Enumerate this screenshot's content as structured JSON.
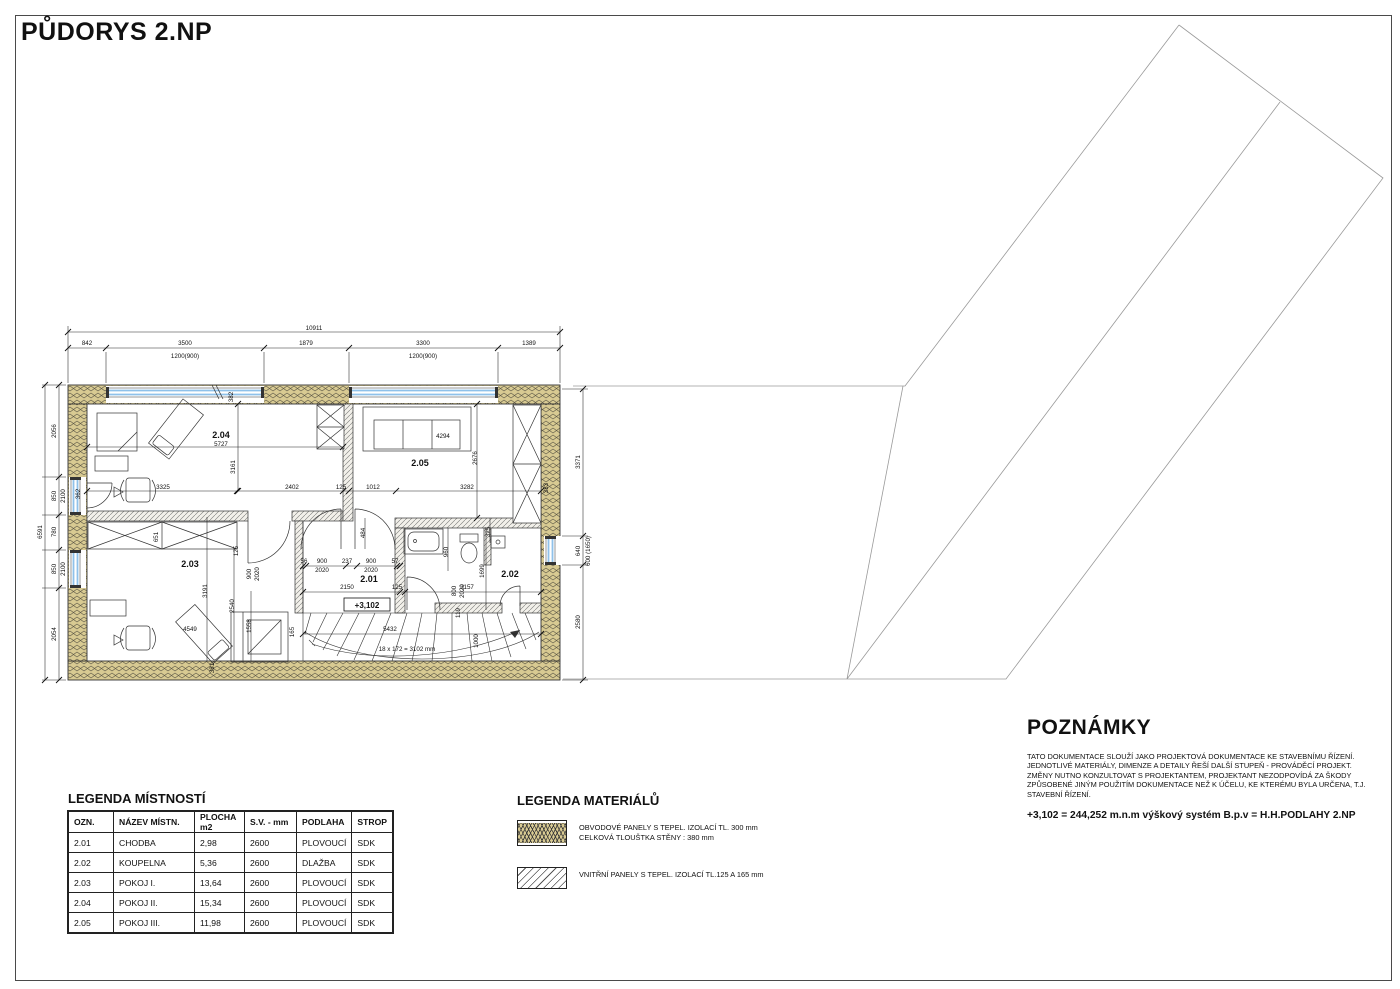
{
  "page": {
    "title": "PŮDORYS 2.NP"
  },
  "room_legend": {
    "title": "LEGENDA MÍSTNOSTÍ",
    "headers": [
      "OZN.",
      "NÁZEV MÍSTN.",
      "PLOCHA m2",
      "S.V. - mm",
      "PODLAHA",
      "STROP"
    ],
    "rows": [
      [
        "2.01",
        "CHODBA",
        "2,98",
        "2600",
        "PLOVOUCÍ",
        "SDK"
      ],
      [
        "2.02",
        "KOUPELNA",
        "5,36",
        "2600",
        "DLAŽBA",
        "SDK"
      ],
      [
        "2.03",
        "POKOJ I.",
        "13,64",
        "2600",
        "PLOVOUCÍ",
        "SDK"
      ],
      [
        "2.04",
        "POKOJ II.",
        "15,34",
        "2600",
        "PLOVOUCÍ",
        "SDK"
      ],
      [
        "2.05",
        "POKOJ III.",
        "11,98",
        "2600",
        "PLOVOUCÍ",
        "SDK"
      ]
    ]
  },
  "materials_legend": {
    "title": "LEGENDA MATERIÁLŮ",
    "items": [
      {
        "swatch": "perimeter-panel-swatch",
        "line1": "OBVODOVÉ PANELY S TEPEL. IZOLACÍ TL. 300 mm",
        "line2": "CELKOVÁ TLOUŠTKA STĚNY : 380 mm"
      },
      {
        "swatch": "interior-panel-swatch",
        "line1": "VNITŘNÍ PANELY S TEPEL. IZOLACÍ TL.125 A 165 mm",
        "line2": ""
      }
    ]
  },
  "notes": {
    "title": "POZNÁMKY",
    "body": "TATO DOKUMENTACE SLOUŽÍ JAKO PROJEKTOVÁ DOKUMENTACE KE STAVEBNÍMU ŘÍZENÍ. JEDNOTLIVÉ MATERIÁLY, DIMENZE A DETAILY ŘEŠÍ DALŠÍ STUPEŇ - PROVÁDĚCÍ PROJEKT. ZMĚNY NUTNO KONZULTOVAT S PROJEKTANTEM, PROJEKTANT NEZODPOVÍDÁ ZA ŠKODY ZPŮSOBENÉ JINÝM POUŽITÍM DOKUMENTACE NEŽ K ÚČELU, KE KTERÉMU BYLA URČENA, T.J. STAVEBNÍ ŘÍZENÍ.",
    "highlight": "+3,102 = 244,252 m.n.m výškový systém B.p.v = H.H.PODLAHY 2.NP"
  },
  "plan": {
    "level_mark": "+3,102",
    "stair_note": "18 x 172 = 3102 mm",
    "labels": [
      {
        "t": "10911",
        "x": 314,
        "y": 330
      },
      {
        "t": "842",
        "x": 87,
        "y": 345
      },
      {
        "t": "3500",
        "x": 185,
        "y": 345
      },
      {
        "t": "1879",
        "x": 306,
        "y": 345
      },
      {
        "t": "3300",
        "x": 423,
        "y": 345
      },
      {
        "t": "1389",
        "x": 529,
        "y": 345
      },
      {
        "t": "1200(900)",
        "x": 185,
        "y": 358
      },
      {
        "t": "1200(900)",
        "x": 423,
        "y": 358
      },
      {
        "t": "6591",
        "x": 42,
        "y": 532,
        "r": -90
      },
      {
        "t": "2056",
        "x": 56,
        "y": 431,
        "r": -90
      },
      {
        "t": "850",
        "x": 56,
        "y": 496,
        "r": -90
      },
      {
        "t": "2100",
        "x": 65,
        "y": 496,
        "r": -90
      },
      {
        "t": "780",
        "x": 56,
        "y": 532,
        "r": -90
      },
      {
        "t": "850",
        "x": 56,
        "y": 569,
        "r": -90
      },
      {
        "t": "2100",
        "x": 65,
        "y": 569,
        "r": -90
      },
      {
        "t": "2054",
        "x": 56,
        "y": 634,
        "r": -90
      },
      {
        "t": "3371",
        "x": 580,
        "y": 462,
        "r": -90
      },
      {
        "t": "640",
        "x": 580,
        "y": 551,
        "r": -90
      },
      {
        "t": "600 (1650)",
        "x": 590,
        "y": 551,
        "r": -90
      },
      {
        "t": "2580",
        "x": 580,
        "y": 622,
        "r": -90
      },
      {
        "t": "2.04",
        "x": 221,
        "y": 438,
        "b": 1,
        "s": 9
      },
      {
        "t": "2.05",
        "x": 420,
        "y": 466,
        "b": 1,
        "s": 9
      },
      {
        "t": "2.03",
        "x": 190,
        "y": 567,
        "b": 1,
        "s": 9
      },
      {
        "t": "2.01",
        "x": 369,
        "y": 582,
        "b": 1,
        "s": 9
      },
      {
        "t": "2.02",
        "x": 510,
        "y": 577,
        "b": 1,
        "s": 9
      },
      {
        "t": "5727",
        "x": 221,
        "y": 446
      },
      {
        "t": "382",
        "x": 233,
        "y": 397,
        "r": -90
      },
      {
        "t": "3325",
        "x": 163,
        "y": 489
      },
      {
        "t": "3161",
        "x": 235,
        "y": 467,
        "r": -90
      },
      {
        "t": "2402",
        "x": 292,
        "y": 489
      },
      {
        "t": "125",
        "x": 341,
        "y": 489
      },
      {
        "t": "1012",
        "x": 373,
        "y": 489
      },
      {
        "t": "3282",
        "x": 467,
        "y": 489
      },
      {
        "t": "383",
        "x": 548,
        "y": 488,
        "r": -90
      },
      {
        "t": "2676",
        "x": 477,
        "y": 458,
        "r": -90
      },
      {
        "t": "4294",
        "x": 443,
        "y": 438
      },
      {
        "t": "362",
        "x": 80,
        "y": 494,
        "r": -90
      },
      {
        "t": "651",
        "x": 158,
        "y": 537,
        "r": -90
      },
      {
        "t": "484",
        "x": 365,
        "y": 533,
        "r": -90
      },
      {
        "t": "125",
        "x": 238,
        "y": 551,
        "r": -90
      },
      {
        "t": "900",
        "x": 251,
        "y": 574,
        "r": -90
      },
      {
        "t": "2020",
        "x": 259,
        "y": 574,
        "r": -90
      },
      {
        "t": "56",
        "x": 304,
        "y": 563
      },
      {
        "t": "900",
        "x": 322,
        "y": 563
      },
      {
        "t": "237",
        "x": 347,
        "y": 563
      },
      {
        "t": "900",
        "x": 371,
        "y": 563
      },
      {
        "t": "57",
        "x": 395,
        "y": 563
      },
      {
        "t": "2020",
        "x": 322,
        "y": 572
      },
      {
        "t": "2020",
        "x": 371,
        "y": 572
      },
      {
        "t": "2150",
        "x": 347,
        "y": 589
      },
      {
        "t": "125",
        "x": 397,
        "y": 589
      },
      {
        "t": "960",
        "x": 448,
        "y": 552,
        "r": -90
      },
      {
        "t": "800",
        "x": 456,
        "y": 591,
        "r": -90
      },
      {
        "t": "2020",
        "x": 464,
        "y": 591,
        "r": -90
      },
      {
        "t": "119",
        "x": 460,
        "y": 613,
        "r": -90
      },
      {
        "t": "1699",
        "x": 484,
        "y": 571,
        "r": -90
      },
      {
        "t": "3157",
        "x": 467,
        "y": 589
      },
      {
        "t": "325",
        "x": 490,
        "y": 532,
        "r": -90
      },
      {
        "t": "3191",
        "x": 207,
        "y": 591,
        "r": -90
      },
      {
        "t": "2540",
        "x": 234,
        "y": 606,
        "r": -90
      },
      {
        "t": "1558",
        "x": 251,
        "y": 626,
        "r": -90
      },
      {
        "t": "4549",
        "x": 190,
        "y": 631
      },
      {
        "t": "165",
        "x": 294,
        "y": 632,
        "r": -90
      },
      {
        "t": "5432",
        "x": 390,
        "y": 631
      },
      {
        "t": "1000",
        "x": 478,
        "y": 641,
        "r": -90
      },
      {
        "t": "381",
        "x": 214,
        "y": 668,
        "r": -90
      },
      {
        "t": "18 x 172 = 3102 mm",
        "x": 407,
        "y": 651
      },
      {
        "t": "+3,102",
        "x": 367,
        "y": 608,
        "b": 1,
        "s": 8,
        "box": 1
      }
    ]
  }
}
